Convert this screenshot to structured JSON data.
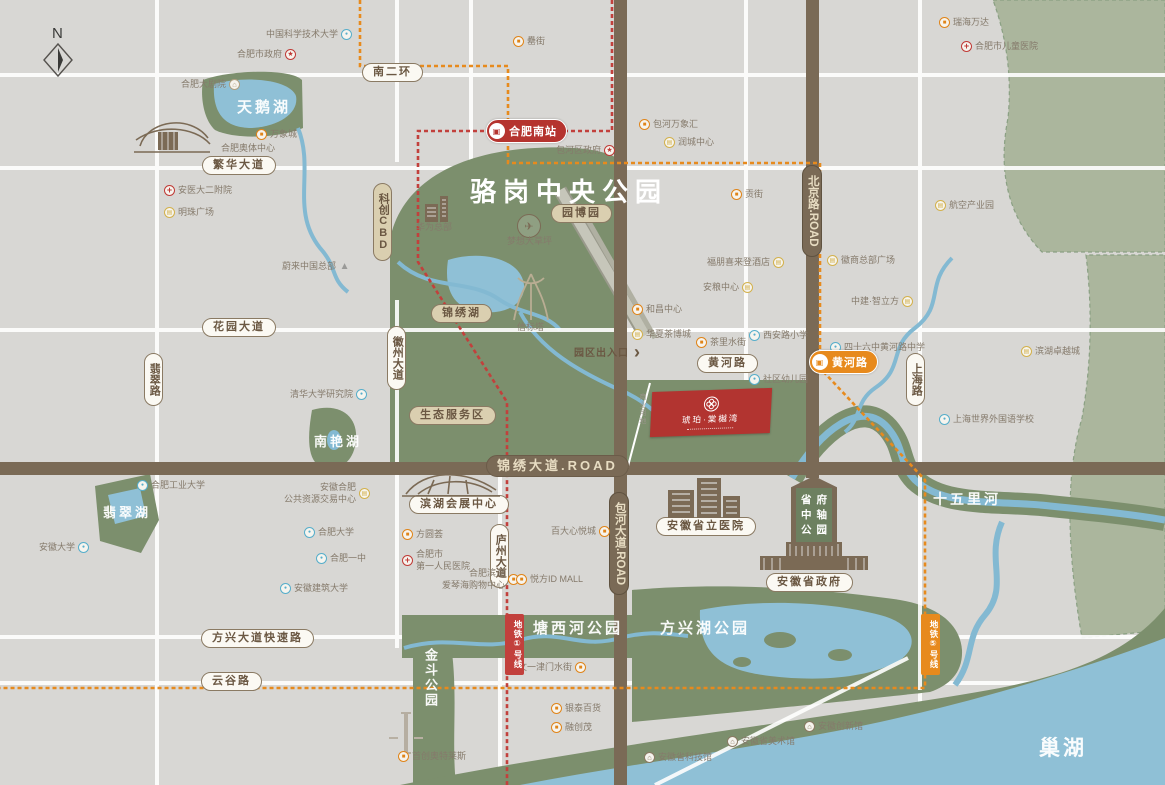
{
  "colors": {
    "bg": "#d8d7d4",
    "park_green": "#7c8f6d",
    "sage": "#abb69d",
    "water": "#8fc0d6",
    "road_brown": "#7a6a56",
    "metro_line1_red": "#c2403c",
    "metro_line5_orange": "#e78a1d",
    "project_red": "#b23430",
    "pill_text": "#6b5843"
  },
  "compass": {
    "label": "N"
  },
  "map": {
    "park_title": "骆岗中央公园"
  },
  "project": {
    "name": "琥珀·棠樾湾",
    "plot_label": "商业用地"
  },
  "entrance": {
    "label": "园区出入口",
    "arrow": "›"
  },
  "axis": {
    "rows": [
      "省府",
      "中轴",
      "公园"
    ]
  },
  "icon_glyphs": {
    "mall": "■",
    "biz": "▤",
    "school": "●",
    "hosp": "+",
    "gov": "★",
    "museum": "⌂",
    "theater": "⌂",
    "nio": "▲"
  },
  "stations": [
    {
      "label": "合肥南站",
      "x": 486,
      "y": 119,
      "color": "#b5342f",
      "glyph": "▣"
    },
    {
      "label": "黄河路",
      "x": 809,
      "y": 350,
      "color": "#e78a1d",
      "glyph": "▣"
    }
  ],
  "line_badges": [
    {
      "label": "地铁①号线",
      "x": 505,
      "y": 614,
      "color": "#c2403c"
    },
    {
      "label": "地铁⑤号线",
      "x": 921,
      "y": 614,
      "color": "#e78a1d"
    }
  ],
  "pills": [
    {
      "t": "南二环",
      "x": 362,
      "y": 63,
      "s": "w"
    },
    {
      "t": "繁华大道",
      "x": 202,
      "y": 156,
      "s": "w"
    },
    {
      "t": "花园大道",
      "x": 202,
      "y": 318,
      "s": "w"
    },
    {
      "t": "黄河路",
      "x": 697,
      "y": 354,
      "s": "w"
    },
    {
      "t": "方兴大道快速路",
      "x": 201,
      "y": 629,
      "s": "w"
    },
    {
      "t": "云谷路",
      "x": 201,
      "y": 672,
      "s": "w"
    },
    {
      "t": "滨湖会展中心",
      "x": 409,
      "y": 495,
      "s": "w"
    },
    {
      "t": "安徽省立医院",
      "x": 656,
      "y": 517,
      "s": "w"
    },
    {
      "t": "安徽省政府",
      "x": 766,
      "y": 573,
      "s": "w"
    },
    {
      "t": "翡翠路",
      "x": 144,
      "y": 353,
      "s": "w",
      "v": true
    },
    {
      "t": "徽州大道",
      "x": 387,
      "y": 326,
      "s": "w",
      "v": true
    },
    {
      "t": "庐州大道",
      "x": 490,
      "y": 524,
      "s": "w",
      "v": true
    },
    {
      "t": "上海路",
      "x": 906,
      "y": 353,
      "s": "w",
      "v": true
    },
    {
      "t": "园博园",
      "x": 551,
      "y": 204,
      "s": "t"
    },
    {
      "t": "锦绣湖",
      "x": 431,
      "y": 304,
      "s": "t"
    },
    {
      "t": "生态服务区",
      "x": 409,
      "y": 406,
      "s": "t"
    },
    {
      "t": "科创CBD",
      "x": 373,
      "y": 183,
      "s": "t",
      "v": true,
      "up": true
    },
    {
      "t": "锦绣大道.ROAD",
      "x": 486,
      "y": 455,
      "s": "b"
    },
    {
      "t": "北京路.ROAD",
      "x": 802,
      "y": 165,
      "s": "b",
      "v": true
    },
    {
      "t": "包河大道.ROAD",
      "x": 609,
      "y": 492,
      "s": "b",
      "v": true
    }
  ],
  "area_labels": [
    {
      "t": "天鹅湖",
      "x": 237,
      "y": 96,
      "fs": 15
    },
    {
      "t": "南艳湖",
      "x": 314,
      "y": 431,
      "fs": 13
    },
    {
      "t": "翡翠湖",
      "x": 103,
      "y": 502,
      "fs": 13
    },
    {
      "t": "塘西河公园",
      "x": 533,
      "y": 617,
      "fs": 15
    },
    {
      "t": "方兴湖公园",
      "x": 660,
      "y": 617,
      "fs": 15
    },
    {
      "t": "金斗公园",
      "x": 421,
      "y": 648,
      "fs": 13,
      "v": true
    },
    {
      "t": "十五里河",
      "x": 933,
      "y": 489,
      "fs": 14
    },
    {
      "t": "巢湖",
      "x": 1039,
      "y": 732,
      "fs": 21
    }
  ],
  "pois": [
    {
      "t": "中国科学技术大学",
      "x": 266,
      "y": 29,
      "k": "school",
      "side": "r"
    },
    {
      "t": "合肥市政府",
      "x": 237,
      "y": 49,
      "k": "gov",
      "side": "r"
    },
    {
      "t": "合肥大剧院",
      "x": 181,
      "y": 79,
      "k": "theater",
      "side": "r"
    },
    {
      "t": "万象城",
      "x": 256,
      "y": 129,
      "k": "mall",
      "side": "l"
    },
    {
      "t": "合肥奥体中心",
      "x": 221,
      "y": 143,
      "k": "plain",
      "side": "l"
    },
    {
      "t": "安医大二附院",
      "x": 164,
      "y": 185,
      "k": "hosp",
      "side": "l"
    },
    {
      "t": "明珠广场",
      "x": 164,
      "y": 207,
      "k": "biz",
      "side": "l"
    },
    {
      "t": "罍街",
      "x": 513,
      "y": 36,
      "k": "mall",
      "side": "l"
    },
    {
      "t": "包河万象汇",
      "x": 639,
      "y": 119,
      "k": "mall",
      "side": "l"
    },
    {
      "t": "润城中心",
      "x": 664,
      "y": 137,
      "k": "biz",
      "side": "l"
    },
    {
      "t": "包河区政府",
      "x": 556,
      "y": 145,
      "k": "gov",
      "side": "r"
    },
    {
      "t": "贡街",
      "x": 731,
      "y": 189,
      "k": "mall",
      "side": "l"
    },
    {
      "t": "瑞海万达",
      "x": 939,
      "y": 17,
      "k": "mall",
      "side": "l"
    },
    {
      "t": "合肥市儿童医院",
      "x": 961,
      "y": 41,
      "k": "hosp",
      "side": "l"
    },
    {
      "t": "航空产业园",
      "x": 935,
      "y": 200,
      "k": "biz",
      "side": "l"
    },
    {
      "t": "徽商总部广场",
      "x": 827,
      "y": 255,
      "k": "biz",
      "side": "l"
    },
    {
      "t": "福朋喜来登酒店",
      "x": 707,
      "y": 257,
      "k": "biz",
      "side": "r"
    },
    {
      "t": "安粮中心",
      "x": 703,
      "y": 282,
      "k": "biz",
      "side": "r"
    },
    {
      "t": "和昌中心",
      "x": 632,
      "y": 304,
      "k": "mall",
      "side": "l"
    },
    {
      "t": "华夏茶博城",
      "x": 632,
      "y": 329,
      "k": "biz",
      "side": "l"
    },
    {
      "t": "茶里水街",
      "x": 696,
      "y": 337,
      "k": "mall",
      "side": "l"
    },
    {
      "t": "西安路小学",
      "x": 749,
      "y": 330,
      "k": "school",
      "side": "l"
    },
    {
      "t": "四十六中黄河路中学",
      "x": 830,
      "y": 342,
      "k": "school",
      "side": "l"
    },
    {
      "t": "社区幼儿园",
      "x": 749,
      "y": 374,
      "k": "school",
      "side": "l"
    },
    {
      "t": "中建·智立方",
      "x": 851,
      "y": 296,
      "k": "biz",
      "side": "r"
    },
    {
      "t": "滨湖卓越城",
      "x": 1021,
      "y": 346,
      "k": "biz",
      "side": "l"
    },
    {
      "t": "上海世界外国语学校",
      "x": 939,
      "y": 414,
      "k": "school",
      "side": "l"
    },
    {
      "t": "蔚来中国总部",
      "x": 282,
      "y": 261,
      "k": "nio",
      "side": "r"
    },
    {
      "t": "清华大学研究院",
      "x": 290,
      "y": 389,
      "k": "school",
      "side": "r"
    },
    {
      "t": "合肥工业大学",
      "x": 137,
      "y": 480,
      "k": "school",
      "side": "l"
    },
    {
      "t": "安徽合肥\n公共资源交易中心",
      "x": 284,
      "y": 482,
      "k": "biz",
      "side": "r"
    },
    {
      "t": "安徽大学",
      "x": 39,
      "y": 542,
      "k": "school",
      "side": "r"
    },
    {
      "t": "合肥大学",
      "x": 304,
      "y": 527,
      "k": "school",
      "side": "l"
    },
    {
      "t": "合肥一中",
      "x": 316,
      "y": 553,
      "k": "school",
      "side": "l"
    },
    {
      "t": "安徽建筑大学",
      "x": 280,
      "y": 583,
      "k": "school",
      "side": "l"
    },
    {
      "t": "方圆荟",
      "x": 402,
      "y": 529,
      "k": "mall",
      "side": "l"
    },
    {
      "t": "合肥市\n第一人民医院",
      "x": 402,
      "y": 549,
      "k": "hosp",
      "side": "l"
    },
    {
      "t": "合肥滨湖\n爱琴海购物中心",
      "x": 442,
      "y": 568,
      "k": "mall",
      "side": "r"
    },
    {
      "t": "百大心悦城",
      "x": 551,
      "y": 526,
      "k": "mall",
      "side": "r"
    },
    {
      "t": "悦方ID MALL",
      "x": 516,
      "y": 574,
      "k": "mall",
      "side": "l"
    },
    {
      "t": "文一津门水街",
      "x": 518,
      "y": 662,
      "k": "mall",
      "side": "r"
    },
    {
      "t": "银泰百货",
      "x": 551,
      "y": 703,
      "k": "mall",
      "side": "l"
    },
    {
      "t": "融创茂",
      "x": 551,
      "y": 722,
      "k": "mall",
      "side": "l"
    },
    {
      "t": "首创奥特莱斯",
      "x": 398,
      "y": 751,
      "k": "mall",
      "side": "l"
    },
    {
      "t": "安徽省科技馆",
      "x": 644,
      "y": 752,
      "k": "museum",
      "side": "l"
    },
    {
      "t": "安徽省美术馆",
      "x": 727,
      "y": 736,
      "k": "museum",
      "side": "l"
    },
    {
      "t": "安徽创新馆",
      "x": 804,
      "y": 721,
      "k": "museum",
      "side": "l"
    },
    {
      "t": "华为总部",
      "x": 416,
      "y": 222,
      "k": "plain",
      "side": "l"
    },
    {
      "t": "梦想大草坪",
      "x": 507,
      "y": 236,
      "k": "plain",
      "side": "l"
    },
    {
      "t": "信标塔",
      "x": 517,
      "y": 322,
      "k": "plain",
      "side": "l"
    }
  ]
}
